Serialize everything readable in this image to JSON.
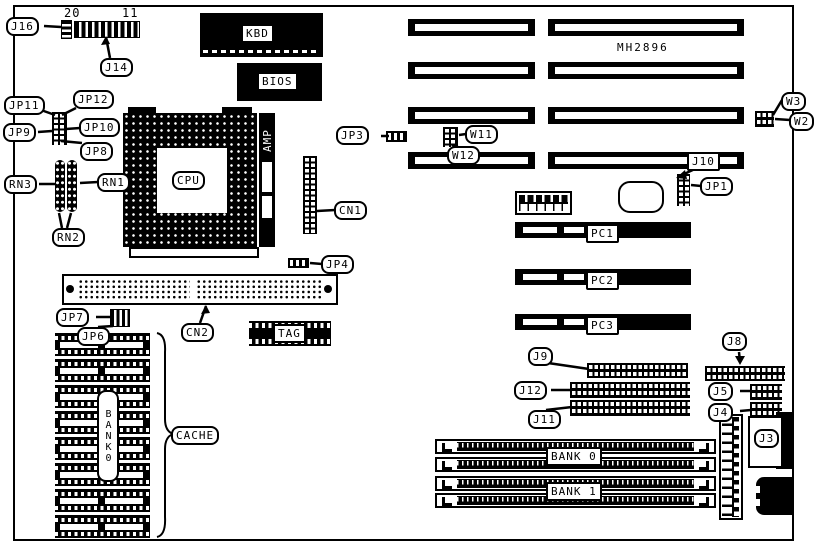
{
  "board": {
    "model": "MH2896"
  },
  "labels": {
    "j16": "J16",
    "j14": "J14",
    "kbd": "KBD",
    "bios": "BIOS",
    "jp11": "JP11",
    "jp12": "JP12",
    "jp9": "JP9",
    "jp10": "JP10",
    "jp8": "JP8",
    "rn1": "RN1",
    "rn2": "RN2",
    "rn3": "RN3",
    "cpu": "CPU",
    "amp": "AMP",
    "jp3": "JP3",
    "cn1": "CN1",
    "jp4": "JP4",
    "cn2": "CN2",
    "tag": "TAG",
    "jp7": "JP7",
    "jp6": "JP6",
    "cache": "CACHE",
    "bank0_vertical": "BANK0",
    "w2": "W2",
    "w3": "W3",
    "w11": "W11",
    "w12": "W12",
    "j10": "J10",
    "jp1": "JP1",
    "pc1": "PC1",
    "pc2": "PC2",
    "pc3": "PC3",
    "j9": "J9",
    "j12": "J12",
    "j11": "J11",
    "j8": "J8",
    "j5": "J5",
    "j4": "J4",
    "j3": "J3",
    "bank0": "BANK 0",
    "bank1": "BANK 1"
  },
  "pin_numbers": {
    "j14_left": "20",
    "j14_right": "11"
  },
  "colors": {
    "ink": "#000000",
    "paper": "#ffffff"
  }
}
